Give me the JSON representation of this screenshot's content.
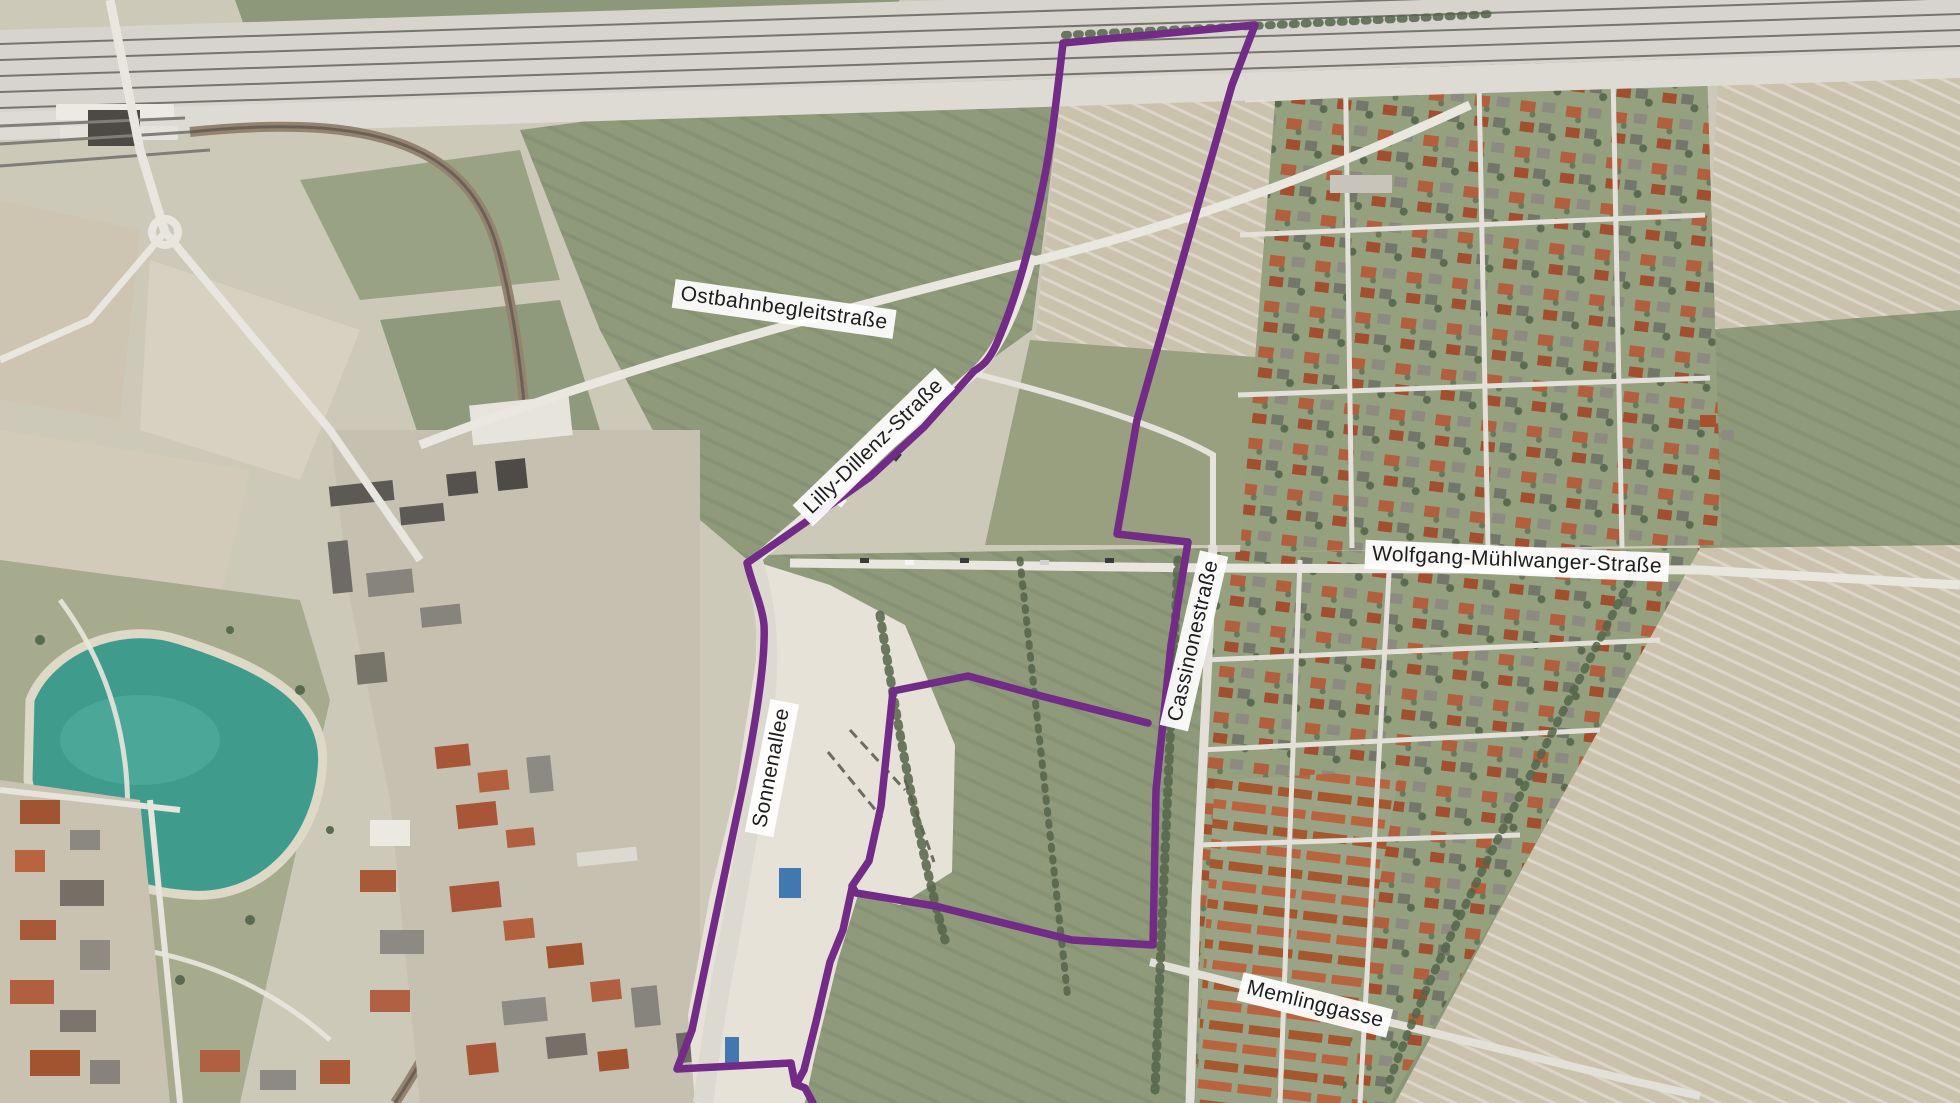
{
  "map": {
    "type": "aerial-satellite-with-project-boundary",
    "labels": {
      "ostbahnbegleitstrasse": "Ostbahnbegleitstraße",
      "lilly_dillenz_strasse": "Lilly-Dillenz-Straße",
      "sonnenallee": "Sonnenallee",
      "cassinonestrasse": "Cassinonestraße",
      "wolfgang_muehlwanger_strasse": "Wolfgang-Mühlwanger-Straße",
      "memlinggasse": "Memlinggasse"
    },
    "label_style": {
      "background": "#ffffff",
      "text_color": "#1d1d1f"
    },
    "boundary": {
      "color": "#722b86",
      "stroke_width": 7.5,
      "paths": {
        "west": "M 1063,43 C 1057,95 1052,140 1044,180 C 1032,240 1016,300 996,345 C 988,362 982,366 974,371 L 924,427 L 870,477 L 806,522 L 747,563 C 752,585 762,605 764,625 C 766,665 752,745 738,810 C 724,878 703,975 692,1030 L 677,1069 L 791,1063 L 795,1084 L 805,1088 L 813,1103",
        "east": "M 1063,43 L 1255,25 L 1232,85 L 1137,420 L 1117,534 L 1188,542 L 1171,645 L 1156,790 L 1153,945 L 1072,940 L 935,906 L 856,893 L 852,886 L 869,861 L 881,806 L 893,691 L 968,676 L 1045,697 L 1148,723",
        "middle": "M 852,888 L 843,930 L 830,962 L 816,1022 L 804,1070 L 797,1083"
      }
    }
  }
}
